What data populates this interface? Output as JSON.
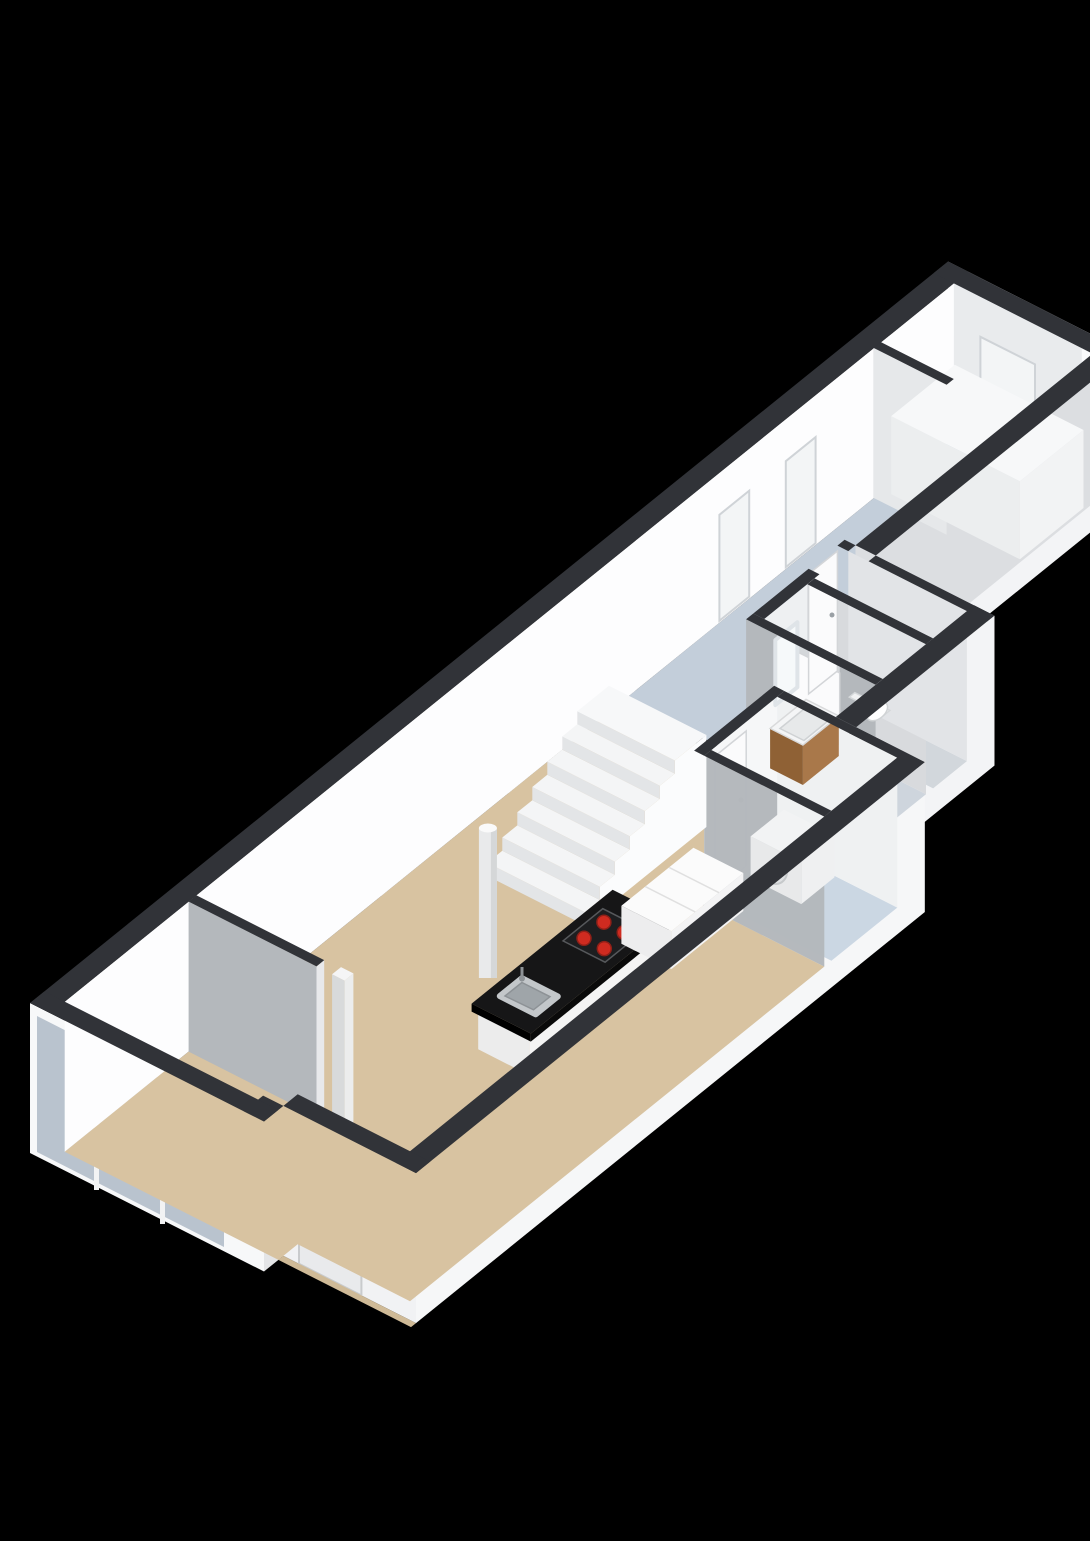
{
  "scene": {
    "title": "3D floor plan — elongated apartment, isometric view",
    "type": "3d-floorplan",
    "stair_steps": 7,
    "hob_burners": 4
  },
  "colors": {
    "background": "#000000",
    "wall_top": "#313338",
    "wall_face_white": "#f7f8f9",
    "wall_face_gray": "#b4b8bc",
    "floor_living": "#d8c3a1",
    "floor_corridor": "#c3ceda",
    "floor_bathroom": "#ced5dd",
    "floor_utility": "#cbd7e3",
    "glass": "#b9c3ce",
    "island_top": "#161617",
    "burner_red": "#cf2b20",
    "cabinet_wood": "#a9784a"
  },
  "labels": {
    "plan": "3D floor plan — elongated apartment, isometric view",
    "living": "Living room / kitchen area",
    "corridor": "Corridor",
    "bathroom": "Bathroom with vanity and mirror",
    "toilet": "Toilet room",
    "utility": "Utility room with washing machine",
    "closet": "Storage closet with cabinet",
    "stairs": "Staircase, 7 steps",
    "island": "Kitchen island with 4-burner hob and sink",
    "counter": "Kitchen counter",
    "washer": "Washing machine",
    "vanity": "Washbasin vanity",
    "mirror": "Mirror",
    "toilet_fixture": "Toilet",
    "front_door": "Front entrance door",
    "windows": "Front window wall",
    "column": "Column",
    "partition": "Partition wall"
  }
}
